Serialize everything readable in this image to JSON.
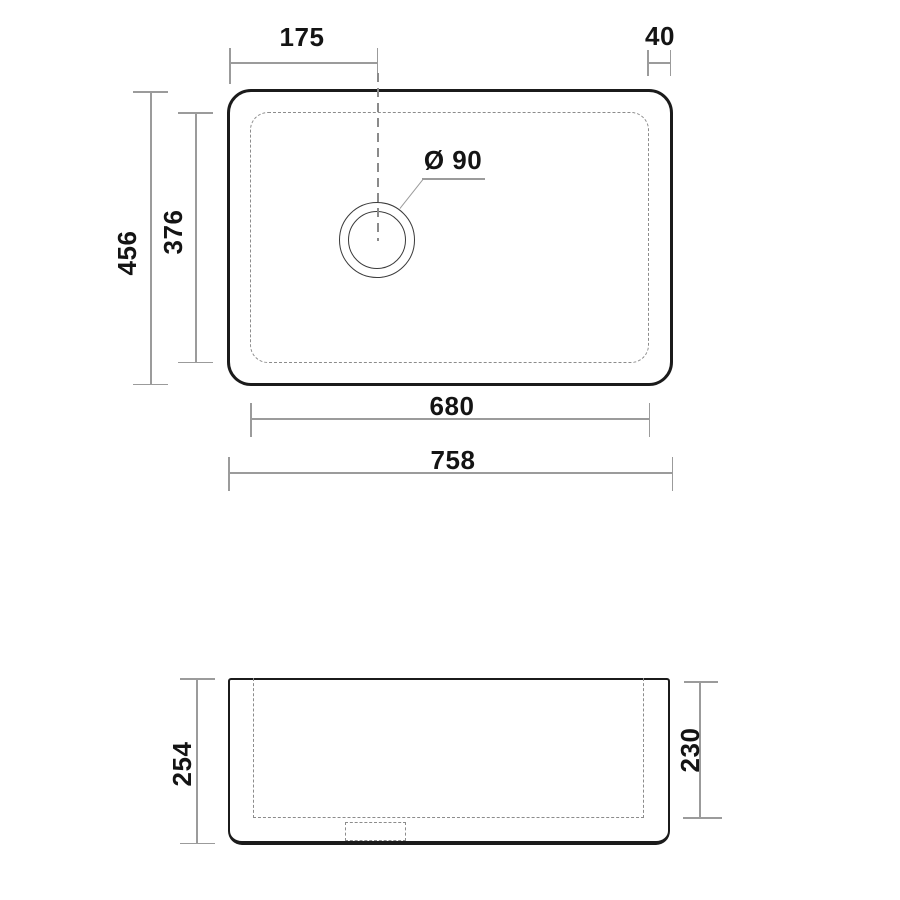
{
  "drawing": {
    "type": "sink technical drawing, top view and front view",
    "colors": {
      "outline": "#1b1b1b",
      "dimension_line": "#9b9b9b",
      "dashed_line": "#8c8c8c",
      "text": "#141414",
      "background": "#ffffff"
    },
    "top_view": {
      "offset_left_to_drain": "175",
      "rim_right": "40",
      "outer_depth": "456",
      "bowl_depth": "376",
      "drain_diameter": "Ø 90",
      "bowl_width": "680",
      "outer_width": "758"
    },
    "front_view": {
      "outer_height": "254",
      "bowl_height": "230"
    }
  }
}
